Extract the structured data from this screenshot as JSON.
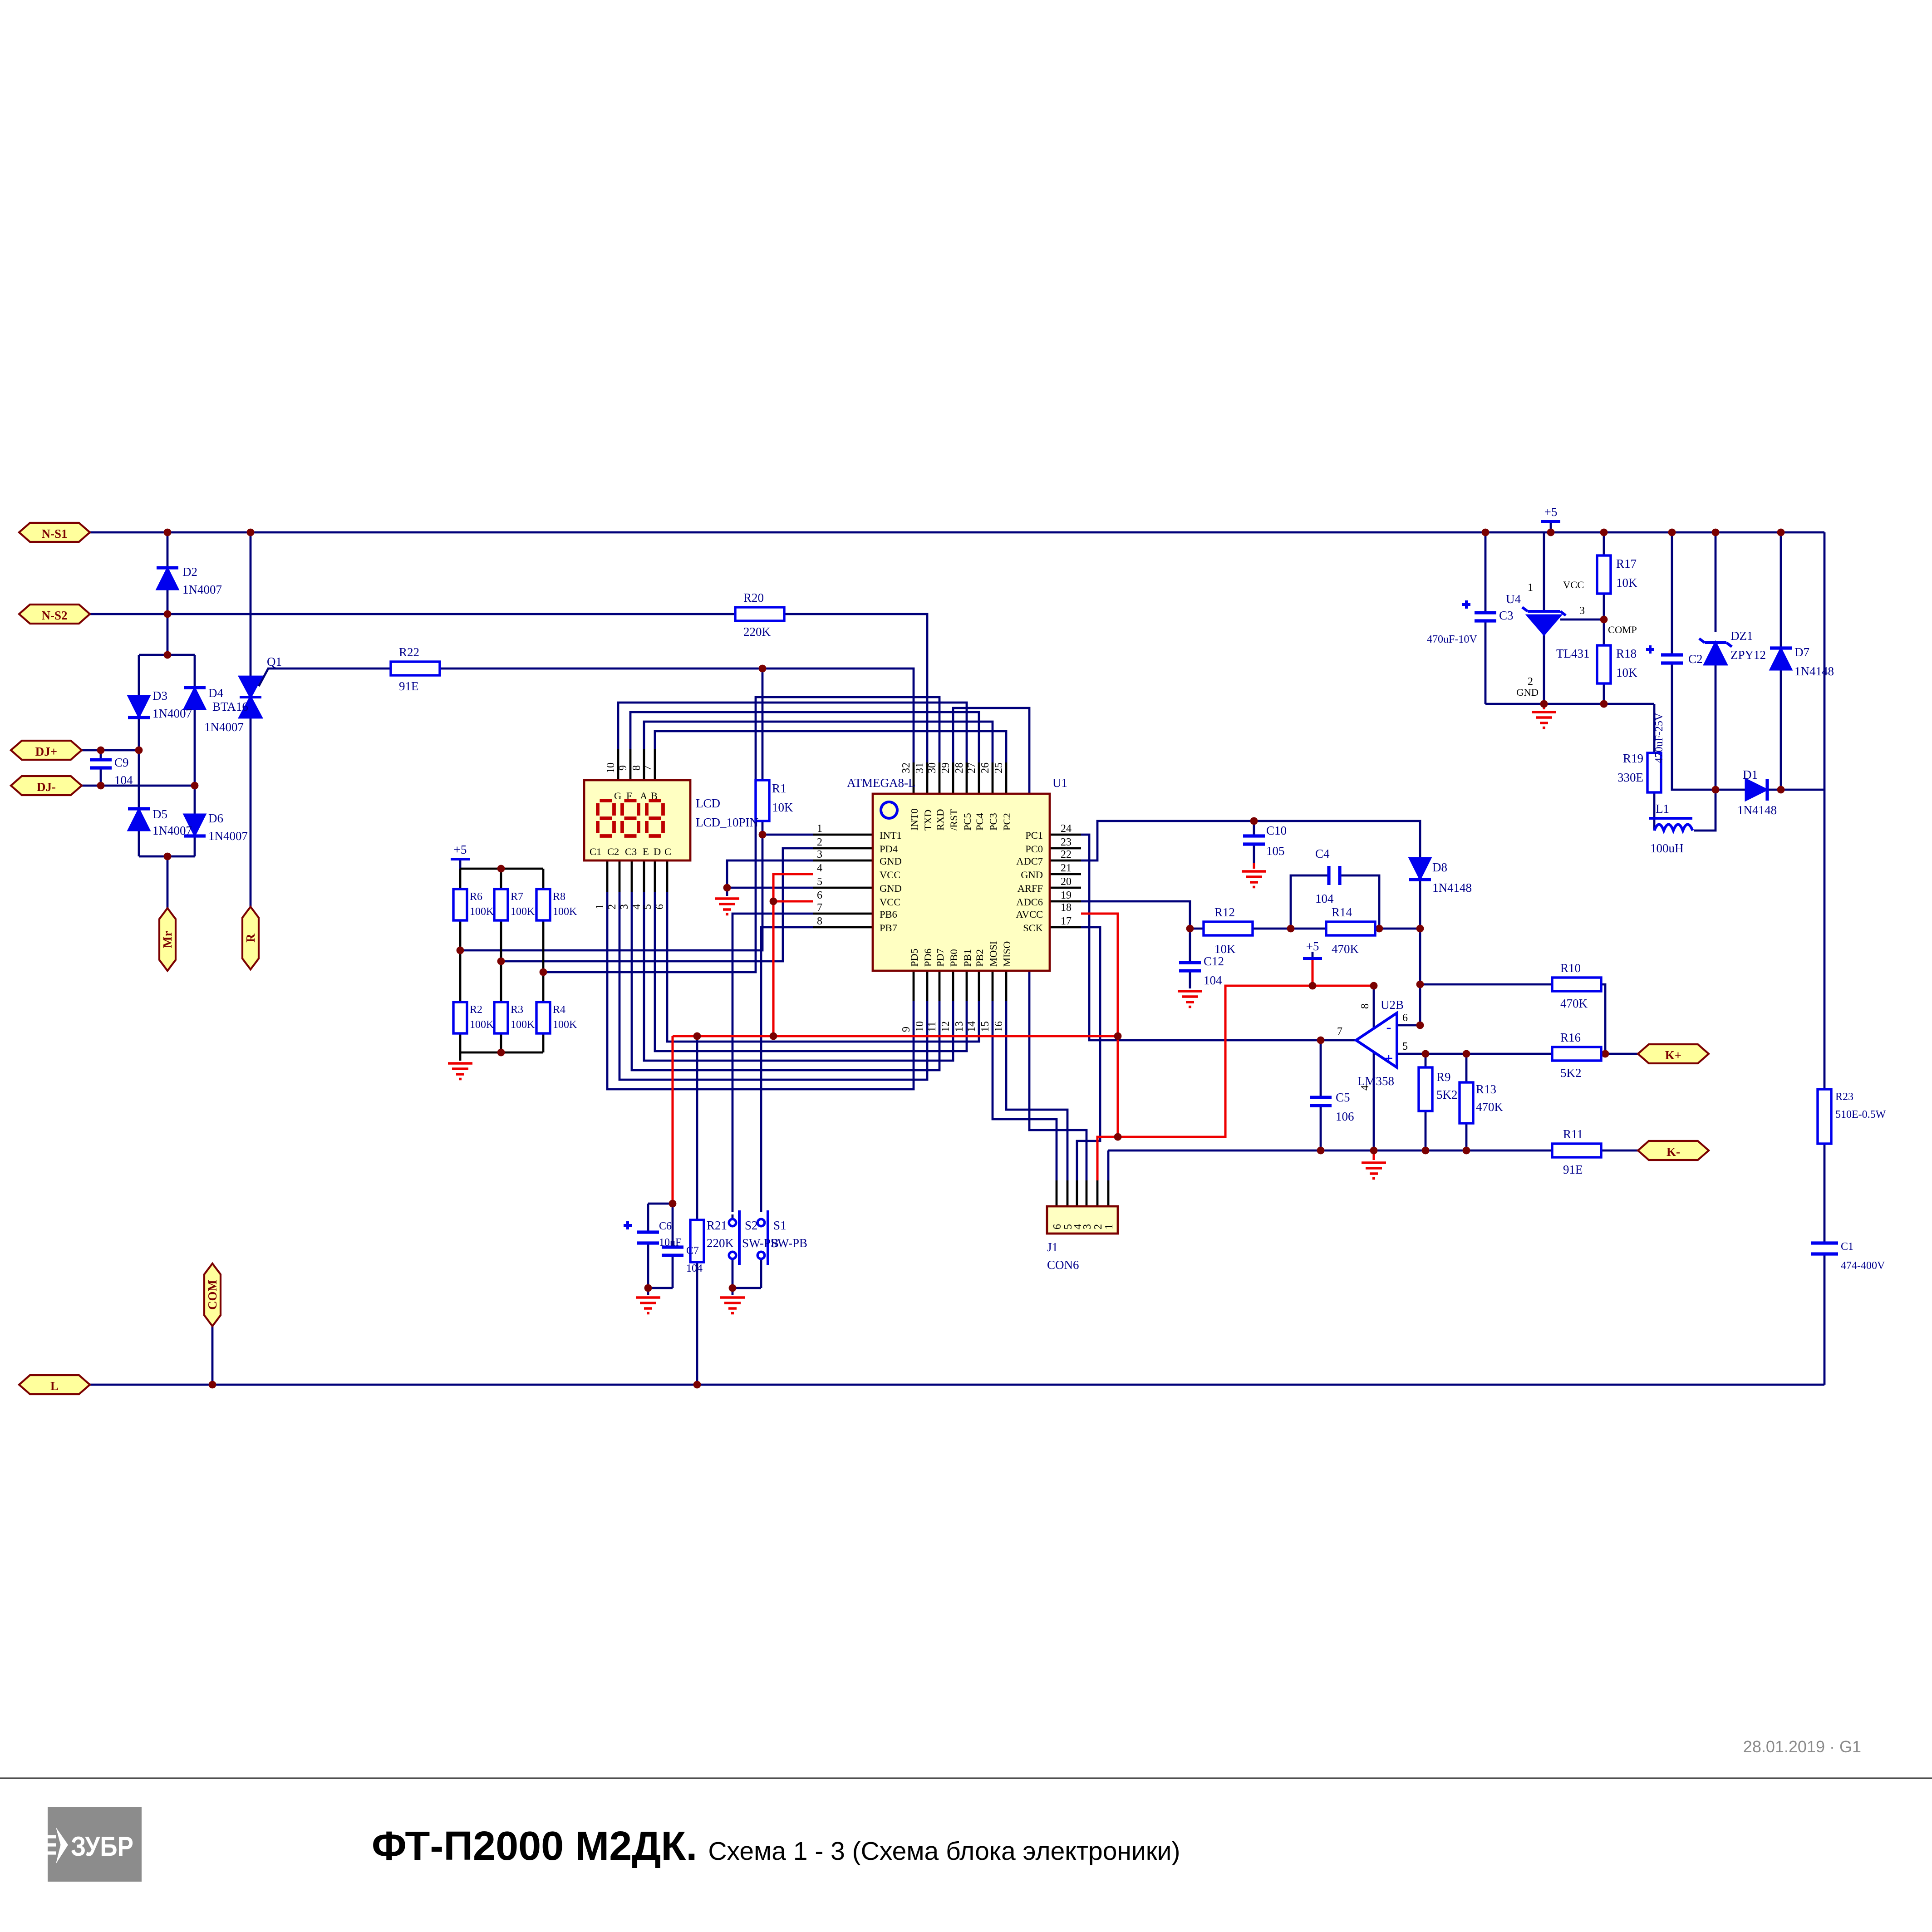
{
  "sheet": {
    "date": "28.01.2019 · G1"
  },
  "footer": {
    "brand": "ЗУБР",
    "title_bold": "ФТ-П2000 М2ДК.",
    "title_rest": "Схема 1 - 3 (Схема блока электроники)"
  },
  "power": {
    "p5": "+5"
  },
  "ports": {
    "ns1": "N-S1",
    "ns2": "N-S2",
    "djp": "DJ+",
    "djm": "DJ-",
    "mr": "Mr",
    "r": "R",
    "com": "COM",
    "l": "L",
    "kp": "K+",
    "km": "K-"
  },
  "parts": {
    "d1": {
      "ref": "D1",
      "val": "1N4148"
    },
    "d2": {
      "ref": "D2",
      "val": "1N4007"
    },
    "d3": {
      "ref": "D3",
      "val": "1N4007"
    },
    "d4": {
      "ref": "D4",
      "val": "1N4007"
    },
    "d5": {
      "ref": "D5",
      "val": "1N4007"
    },
    "d6": {
      "ref": "D6",
      "val": "1N4007"
    },
    "d7": {
      "ref": "D7",
      "val": "1N4148"
    },
    "d8": {
      "ref": "D8",
      "val": "1N4148"
    },
    "dz1": {
      "ref": "DZ1",
      "val": "ZPY12"
    },
    "q1": {
      "ref": "Q1",
      "val": "BTA16"
    },
    "l1": {
      "ref": "L1",
      "val": "100uH"
    },
    "r1": {
      "ref": "R1",
      "val": "10K"
    },
    "r2": {
      "ref": "R2",
      "val": "100K"
    },
    "r3": {
      "ref": "R3",
      "val": "100K"
    },
    "r4": {
      "ref": "R4",
      "val": "100K"
    },
    "r6": {
      "ref": "R6",
      "val": "100K"
    },
    "r7": {
      "ref": "R7",
      "val": "100K"
    },
    "r8": {
      "ref": "R8",
      "val": "100K"
    },
    "r9": {
      "ref": "R9",
      "val": "5K2"
    },
    "r10": {
      "ref": "R10",
      "val": "470K"
    },
    "r11": {
      "ref": "R11",
      "val": "91E"
    },
    "r12": {
      "ref": "R12",
      "val": "10K"
    },
    "r13": {
      "ref": "R13",
      "val": "470K"
    },
    "r14": {
      "ref": "R14",
      "val": "470K"
    },
    "r16": {
      "ref": "R16",
      "val": "5K2"
    },
    "r17": {
      "ref": "R17",
      "val": "10K"
    },
    "r18": {
      "ref": "R18",
      "val": "10K"
    },
    "r19": {
      "ref": "R19",
      "val": "330E"
    },
    "r20": {
      "ref": "R20",
      "val": "220K"
    },
    "r21": {
      "ref": "R21",
      "val": "220K"
    },
    "r22": {
      "ref": "R22",
      "val": "91E"
    },
    "r23": {
      "ref": "R23",
      "val": "510E-0.5W"
    },
    "c1": {
      "ref": "C1",
      "val": "474-400V"
    },
    "c2": {
      "ref": "C2",
      "val": "470uF-25V"
    },
    "c3": {
      "ref": "C3",
      "val": "470uF-10V"
    },
    "c4": {
      "ref": "C4",
      "val": "104"
    },
    "c5": {
      "ref": "C5",
      "val": "106"
    },
    "c6": {
      "ref": "C6",
      "val": "10uF"
    },
    "c7": {
      "ref": "C7",
      "val": "104"
    },
    "c9": {
      "ref": "C9",
      "val": "104"
    },
    "c10": {
      "ref": "C10",
      "val": "105"
    },
    "c12": {
      "ref": "C12",
      "val": "104"
    },
    "s1": {
      "ref": "S1",
      "val": "SW-PB"
    },
    "s2": {
      "ref": "S2",
      "val": "SW-PB"
    }
  },
  "u1": {
    "ref": "U1",
    "part": "ATMEGA8-L",
    "left_names": [
      "INT1",
      "PD4",
      "GND",
      "VCC",
      "GND",
      "VCC",
      "PB6",
      "PB7"
    ],
    "left_nums": [
      "1",
      "2",
      "3",
      "4",
      "5",
      "6",
      "7",
      "8"
    ],
    "right_names": [
      "PC1",
      "PC0",
      "ADC7",
      "GND",
      "ARFF",
      "ADC6",
      "AVCC",
      "SCK"
    ],
    "right_nums": [
      "24",
      "23",
      "22",
      "21",
      "20",
      "19",
      "18",
      "17"
    ],
    "top_names": [
      "INT0",
      "TXD",
      "RXD",
      "/RST",
      "PC5",
      "PC4",
      "PC3",
      "PC2"
    ],
    "top_nums": [
      "32",
      "31",
      "30",
      "29",
      "28",
      "27",
      "26",
      "25"
    ],
    "bottom_names": [
      "PD5",
      "PD6",
      "PD7",
      "PB0",
      "PB1",
      "PB2",
      "MOSI",
      "MISO"
    ],
    "bottom_nums": [
      "9",
      "10",
      "11",
      "12",
      "13",
      "14",
      "15",
      "16"
    ]
  },
  "lcd": {
    "ref": "LCD",
    "part": "LCD_10PIN",
    "top_nums": [
      "10",
      "9",
      "8",
      "7"
    ],
    "top_names": [
      "G",
      "F",
      "A",
      "B"
    ],
    "bottom_nums": [
      "1",
      "2",
      "3",
      "4",
      "5",
      "6"
    ],
    "bottom_names": [
      "C1",
      "C2",
      "C3",
      "E",
      "D",
      "C"
    ]
  },
  "u4": {
    "ref": "U4",
    "part": "TL431",
    "p1": "1",
    "p2": "2",
    "p3": "3",
    "vcc": "VCC",
    "gnd": "GND",
    "comp": "COMP"
  },
  "u2b": {
    "ref": "U2B",
    "part": "LM358",
    "p4": "4",
    "p5": "5",
    "p6": "6",
    "p7": "7",
    "p8": "8",
    "plus": "+",
    "minus": "-"
  },
  "j1": {
    "ref": "J1",
    "part": "CON6",
    "nums": [
      "6",
      "5",
      "4",
      "3",
      "2",
      "1"
    ]
  }
}
